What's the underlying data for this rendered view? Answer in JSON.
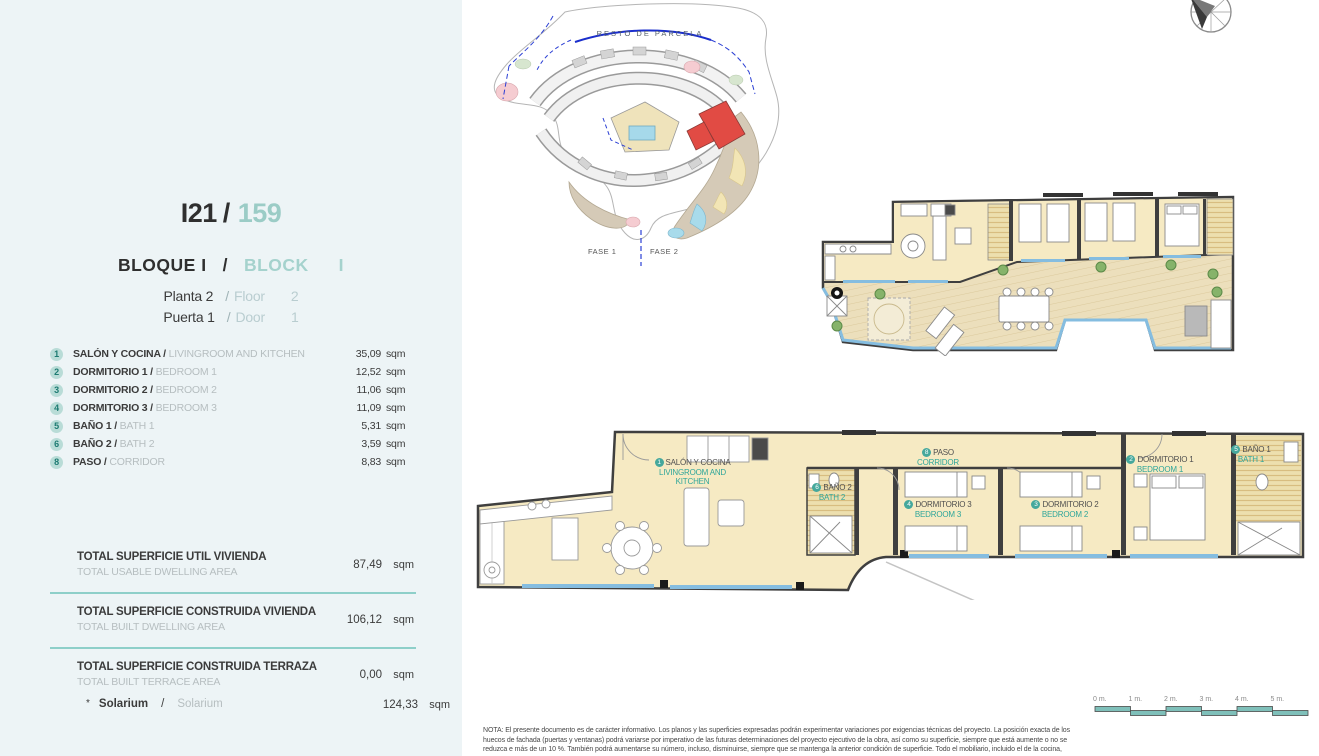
{
  "colors": {
    "panel_bg": "#edf4f6",
    "accent_teal": "#2fa69a",
    "muted_teal": "#9bccc6",
    "divider_teal": "#8ecfc9",
    "dark_text": "#3b3b3b",
    "gray_text": "#b6bec0",
    "room_fill_cream": "#f6eac3",
    "deck_wood": "#ecdfbc",
    "glass_blue": "#85bde0",
    "wall": "#3f3f3f",
    "highlight_red": "#e14b44"
  },
  "header": {
    "unit_code": "I21",
    "separator": "/",
    "unit_number": "159",
    "block_es": "BLOQUE  I",
    "block_en": "BLOCK",
    "block_en_num": "I",
    "floor_es": "Planta 2",
    "floor_en": "Floor",
    "floor_num": "2",
    "door_es": "Puerta 1",
    "door_en": "Door",
    "door_num": "1"
  },
  "rooms": [
    {
      "num": "1",
      "name_es": "SALÓN Y COCINA",
      "name_en": "LIVINGROOM AND KITCHEN",
      "area": "35,09",
      "unit": "sqm"
    },
    {
      "num": "2",
      "name_es": "DORMITORIO 1",
      "name_en": "BEDROOM 1",
      "area": "12,52",
      "unit": "sqm"
    },
    {
      "num": "3",
      "name_es": "DORMITORIO 2",
      "name_en": "BEDROOM 2",
      "area": "11,06",
      "unit": "sqm"
    },
    {
      "num": "4",
      "name_es": "DORMITORIO 3",
      "name_en": "BEDROOM 3",
      "area": "11,09",
      "unit": "sqm"
    },
    {
      "num": "5",
      "name_es": "BAÑO 1",
      "name_en": "BATH 1",
      "area": "5,31",
      "unit": "sqm"
    },
    {
      "num": "6",
      "name_es": "BAÑO 2",
      "name_en": "BATH 2",
      "area": "3,59",
      "unit": "sqm"
    },
    {
      "num": "8",
      "name_es": "PASO",
      "name_en": "CORRIDOR",
      "area": "8,83",
      "unit": "sqm"
    }
  ],
  "totals": [
    {
      "label_es": "TOTAL SUPERFICIE UTIL VIVIENDA",
      "label_en": "TOTAL USABLE DWELLING AREA",
      "value": "87,49",
      "unit": "sqm"
    },
    {
      "label_es": "TOTAL SUPERFICIE CONSTRUIDA VIVIENDA",
      "label_en": "TOTAL BUILT DWELLING AREA",
      "value": "106,12",
      "unit": "sqm"
    },
    {
      "label_es": "TOTAL SUPERFICIE CONSTRUIDA TERRAZA",
      "label_en": "TOTAL BUILT TERRACE AREA",
      "value": "0,00",
      "unit": "sqm"
    }
  ],
  "solarium": {
    "marker": "*",
    "label_es": "Solarium",
    "separator": "/",
    "label_en": "Solarium",
    "value": "124,33",
    "unit": "sqm"
  },
  "site_plan": {
    "area_label": "RESTO DE PARCELA",
    "phase1": "FASE 1",
    "phase2": "FASE 2"
  },
  "scale_bar": {
    "labels": [
      "0 m.",
      "1 m.",
      "2 m.",
      "3 m.",
      "4 m.",
      "5 m."
    ]
  },
  "note": {
    "lines": [
      "NOTA: El presente documento es de carácter informativo. Los planos y las superficies expresadas podrán experimentar variaciones por exigencias técnicas del proyecto. La posición exacta de los",
      "huecos de fachada (puertas y ventanas) podrá variarse por imperativo de las futuras determinaciones del proyecto ejecutivo de la obra, así como su superficie, siempre que está aumente o no se",
      "reduzca e más de un 10 %. También podrá aumentarse su número, incluso, disminuirse, siempre que se mantenga la anterior condición de superficie. Todo el mobiliario, incluido el de la cocina,"
    ]
  }
}
